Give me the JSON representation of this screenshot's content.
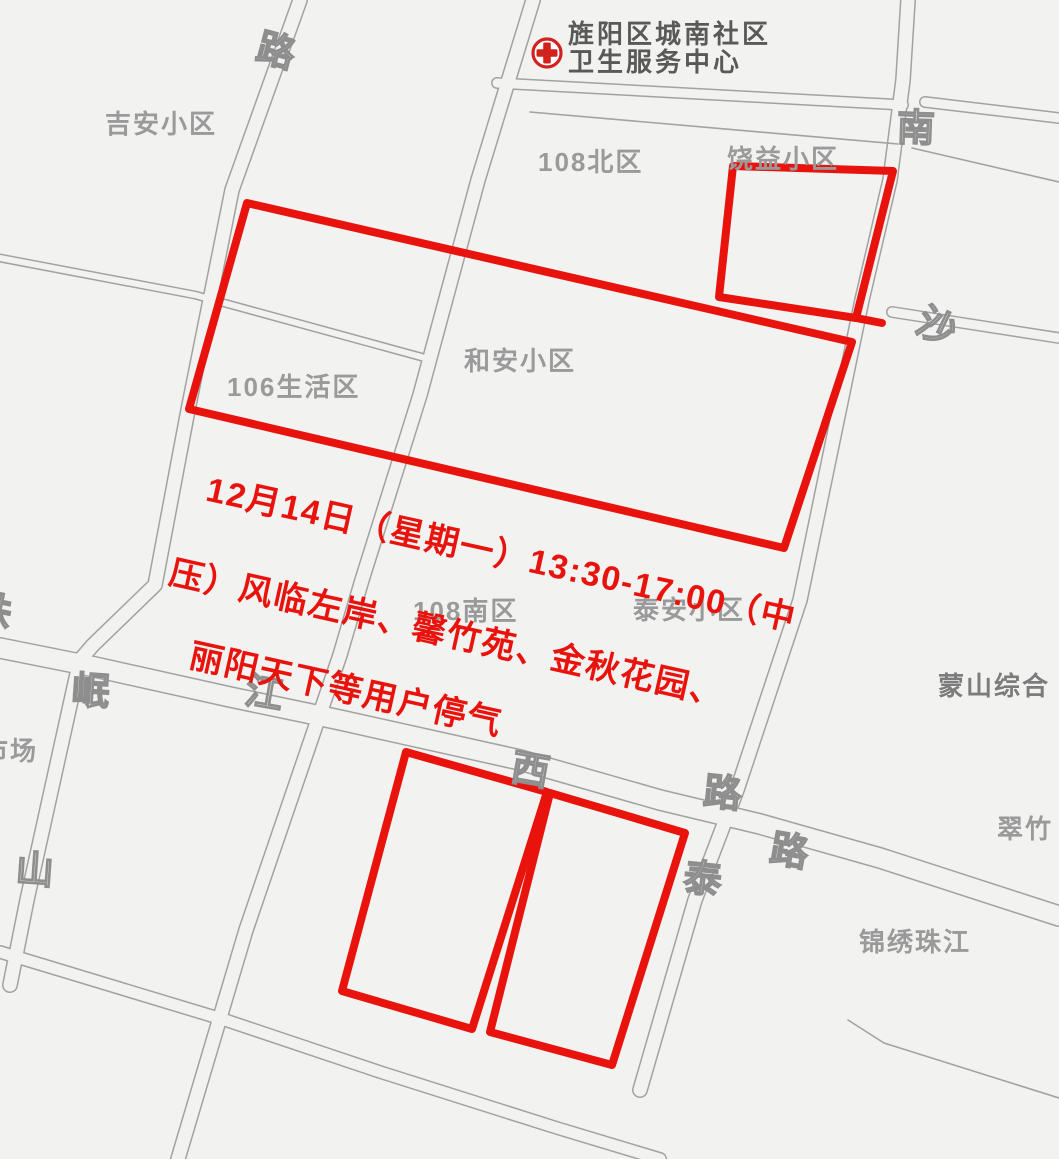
{
  "map": {
    "background": "#f2f2f1",
    "road_line_color": "#a2a2a2",
    "red_color": "#e9130e",
    "label_color": "#9a9a9a",
    "poi": {
      "icon": "hospital-red-cross-icon",
      "line1": "旌阳区城南社区",
      "line2": "卫生服务中心"
    },
    "notice": {
      "color": "#e9130e",
      "lines": [
        {
          "text": "12月14日（星期一）13:30-17:00（中",
          "x": 213,
          "y": 462,
          "rotate": 12.5
        },
        {
          "text": "压）风临左岸、馨竹苑、金秋花园、",
          "x": 176,
          "y": 545,
          "rotate": 12.5
        },
        {
          "text": "丽阳天下等用户停气",
          "x": 196,
          "y": 628,
          "rotate": 12.5
        }
      ]
    },
    "area_labels": [
      {
        "id": "jian-xiaoqu",
        "text": "吉安小区",
        "x": 105,
        "y": 104
      },
      {
        "id": "108-beiqu",
        "text": "108北区",
        "x": 538,
        "y": 142
      },
      {
        "id": "raoyi-xiaoqu",
        "text": "饶益小区",
        "x": 727,
        "y": 139
      },
      {
        "id": "hean-xiaoqu",
        "text": "和安小区",
        "x": 464,
        "y": 341
      },
      {
        "id": "106-shenghuoqu",
        "text": "106生活区",
        "x": 227,
        "y": 367
      },
      {
        "id": "108-nanqu",
        "text": "108南区",
        "x": 413,
        "y": 591
      },
      {
        "id": "taian-xiaoqu",
        "text": "泰安小区",
        "x": 633,
        "y": 590
      },
      {
        "id": "mengshan-zonghe",
        "text": "蒙山综合",
        "x": 938,
        "y": 666,
        "dark": true
      },
      {
        "id": "cuizhu",
        "text": "翠竹",
        "x": 997,
        "y": 809
      },
      {
        "id": "jinxiu-zhujiang",
        "text": "锦绣珠江",
        "x": 859,
        "y": 922
      },
      {
        "id": "shichang-partial",
        "text": "市场",
        "x": -18,
        "y": 731
      }
    ],
    "road_labels": [
      {
        "id": "lu-topleft",
        "text": "路",
        "x": 258,
        "y": 20,
        "rotate": 15
      },
      {
        "id": "nan",
        "text": "南",
        "x": 897,
        "y": 97,
        "rotate": 2
      },
      {
        "id": "sha",
        "text": "沙",
        "x": 919,
        "y": 296,
        "rotate": 26
      },
      {
        "id": "zhu-partial",
        "text": "珠",
        "x": -26,
        "y": 580,
        "rotate": 12
      },
      {
        "id": "jiang",
        "text": "江",
        "x": 246,
        "y": 662,
        "rotate": 10
      },
      {
        "id": "xi",
        "text": "西",
        "x": 512,
        "y": 739,
        "rotate": 10
      },
      {
        "id": "lu-center",
        "text": "路",
        "x": 704,
        "y": 762,
        "rotate": 6
      },
      {
        "id": "tai",
        "text": "泰",
        "x": 684,
        "y": 848,
        "rotate": 6
      },
      {
        "id": "lu-east",
        "text": "路",
        "x": 771,
        "y": 820,
        "rotate": 10
      },
      {
        "id": "min",
        "text": "岷",
        "x": 72,
        "y": 660,
        "rotate": 4
      },
      {
        "id": "shan",
        "text": "山",
        "x": 16,
        "y": 839,
        "rotate": 4
      }
    ],
    "roads": [
      {
        "id": "road-northwest-vertical",
        "width": 16,
        "points": [
          [
            300,
            0
          ],
          [
            232,
            190
          ],
          [
            188,
            410
          ],
          [
            155,
            585
          ],
          [
            93,
            645
          ],
          [
            80,
            660
          ],
          [
            27,
            900
          ],
          [
            10,
            985
          ]
        ]
      },
      {
        "id": "road-center-vertical",
        "width": 16,
        "points": [
          [
            533,
            0
          ],
          [
            478,
            180
          ],
          [
            420,
            395
          ],
          [
            362,
            580
          ],
          [
            340,
            655
          ],
          [
            246,
            930
          ],
          [
            178,
            1159
          ]
        ]
      },
      {
        "id": "road-east-vertical-taishan",
        "width": 16,
        "points": [
          [
            908,
            0
          ],
          [
            903,
            80
          ],
          [
            890,
            180
          ],
          [
            862,
            300
          ],
          [
            800,
            600
          ],
          [
            737,
            790
          ],
          [
            695,
            900
          ],
          [
            640,
            1090
          ]
        ]
      },
      {
        "id": "road-zhujiang-west",
        "width": 22,
        "points": [
          [
            0,
            648
          ],
          [
            95,
            667
          ],
          [
            230,
            697
          ],
          [
            340,
            720
          ],
          [
            520,
            760
          ],
          [
            660,
            800
          ],
          [
            760,
            824
          ],
          [
            880,
            858
          ],
          [
            1059,
            916
          ]
        ]
      },
      {
        "id": "road-south-horizontal",
        "width": 14,
        "points": [
          [
            0,
            952
          ],
          [
            225,
            1020
          ],
          [
            380,
            1072
          ],
          [
            557,
            1128
          ],
          [
            660,
            1159
          ]
        ]
      },
      {
        "id": "road-north-east-stub",
        "width": 12,
        "points": [
          [
            925,
            102
          ],
          [
            1059,
            118
          ]
        ]
      },
      {
        "id": "road-sha-east",
        "width": 12,
        "points": [
          [
            892,
            312
          ],
          [
            1059,
            338
          ]
        ]
      },
      {
        "id": "road-106-diagonal",
        "width": 9,
        "points": [
          [
            0,
            258
          ],
          [
            195,
            295
          ],
          [
            425,
            358
          ]
        ]
      },
      {
        "id": "road-health-center-front",
        "width": 12,
        "points": [
          [
            497,
            83
          ],
          [
            700,
            94
          ],
          [
            903,
            105
          ]
        ]
      }
    ],
    "boundary_lines": [
      {
        "id": "block-line-108north-top",
        "points": [
          [
            530,
            112
          ],
          [
            898,
            144
          ]
        ]
      },
      {
        "id": "block-line-northeast",
        "points": [
          [
            912,
            148
          ],
          [
            1059,
            182
          ]
        ]
      },
      {
        "id": "block-line-southeast",
        "points": [
          [
            848,
            1020
          ],
          [
            884,
            1043
          ],
          [
            1059,
            1098
          ]
        ]
      }
    ],
    "red_shapes": [
      {
        "id": "outage-zone-main",
        "closed": true,
        "points": [
          [
            247,
            203
          ],
          [
            852,
            342
          ],
          [
            784,
            548
          ],
          [
            189,
            409
          ]
        ]
      },
      {
        "id": "outage-zone-northeast",
        "closed": true,
        "points": [
          [
            733,
            166
          ],
          [
            893,
            171
          ],
          [
            856,
            318
          ],
          [
            719,
            297
          ]
        ]
      },
      {
        "id": "outage-zone-northeast-tail",
        "closed": false,
        "points": [
          [
            856,
            318
          ],
          [
            882,
            323
          ]
        ]
      },
      {
        "id": "outage-zone-southwest",
        "closed": true,
        "points": [
          [
            406,
            752
          ],
          [
            547,
            792
          ],
          [
            472,
            1029
          ],
          [
            342,
            991
          ]
        ]
      },
      {
        "id": "outage-zone-south",
        "closed": true,
        "points": [
          [
            550,
            793
          ],
          [
            685,
            833
          ],
          [
            612,
            1065
          ],
          [
            490,
            1032
          ]
        ]
      }
    ]
  }
}
